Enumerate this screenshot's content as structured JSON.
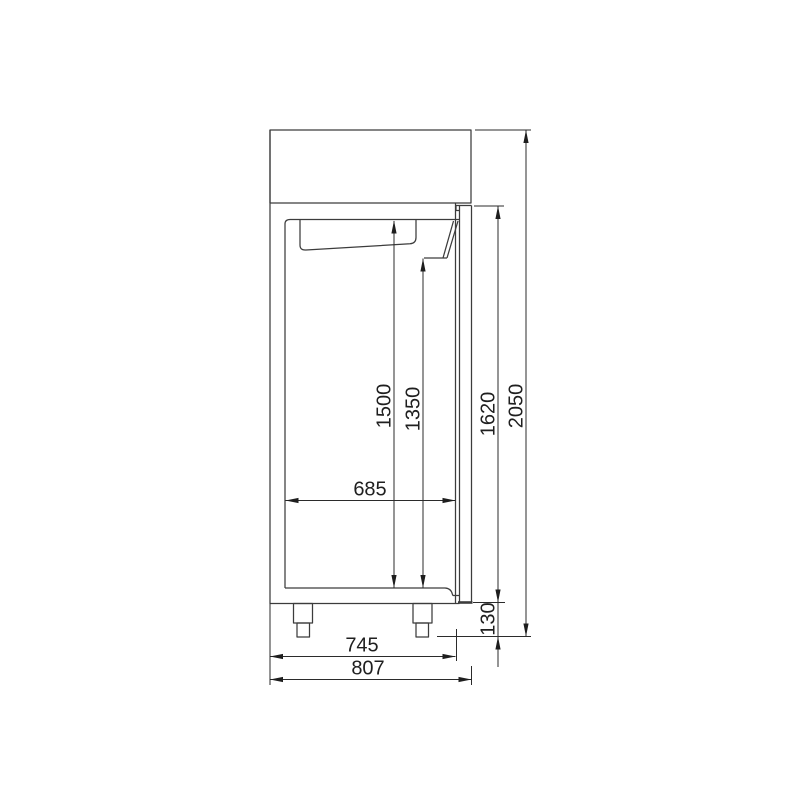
{
  "drawing": {
    "type": "technical-dimension-drawing",
    "subject": "upright-cabinet-side-view",
    "background_color": "#ffffff",
    "object_line_color": "#3c3c3c",
    "dimension_line_color": "#2b2b2b",
    "text_color": "#1f1f1f",
    "dims": {
      "interior_height_rear": "1500",
      "interior_height_front": "1350",
      "door_height": "1620",
      "overall_height": "2050",
      "interior_depth": "685",
      "body_depth": "745",
      "overall_depth": "807",
      "plinth_height": "130"
    }
  }
}
